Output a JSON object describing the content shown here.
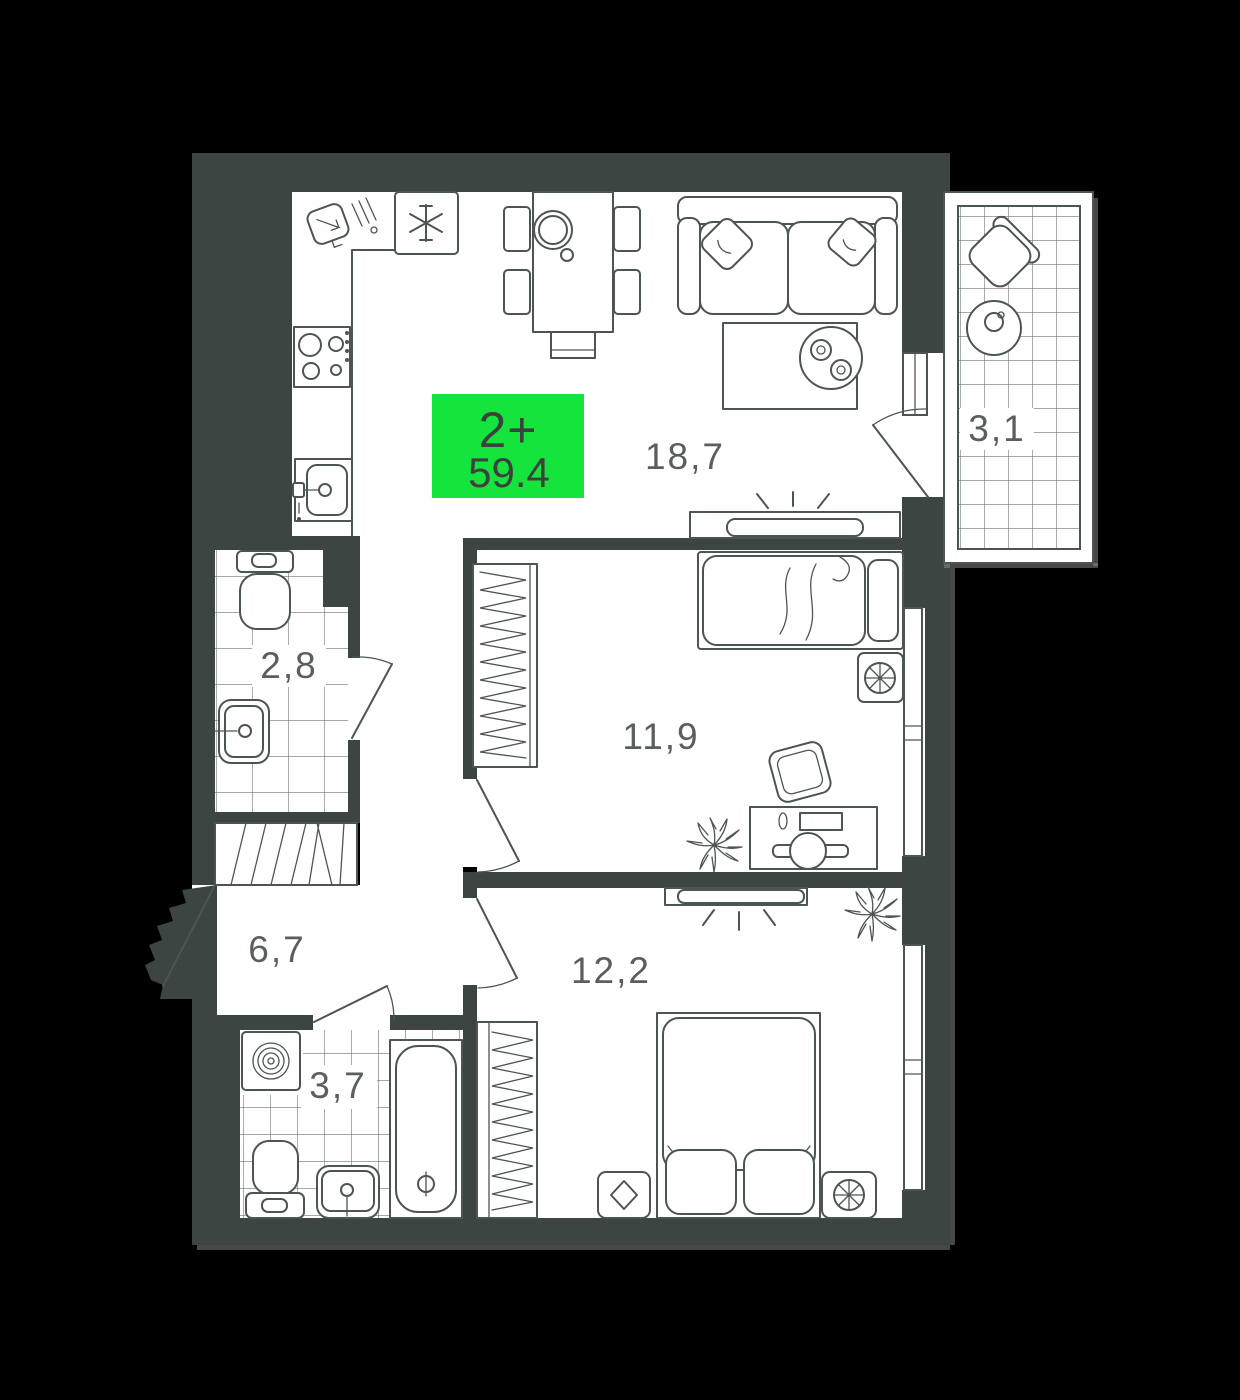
{
  "plan": {
    "badge": {
      "rooms_label": "2+",
      "total_area": "59.4",
      "bg_color": "#15e43c",
      "text_color": "#3a4240"
    },
    "rooms": [
      {
        "id": "kitchen-living",
        "area_label": "18,7"
      },
      {
        "id": "balcony",
        "area_label": "3,1"
      },
      {
        "id": "bathroom-small",
        "area_label": "2,8"
      },
      {
        "id": "bedroom-1",
        "area_label": "11,9"
      },
      {
        "id": "hallway",
        "area_label": "6,7"
      },
      {
        "id": "bedroom-2",
        "area_label": "12,2"
      },
      {
        "id": "bathroom-big",
        "area_label": "3,7"
      }
    ],
    "colors": {
      "background": "#000000",
      "wall": "#3d4543",
      "floor": "#ffffff",
      "outline": "#4d5553",
      "tile_grid": "#6d7472",
      "label_text": "#585f5d"
    }
  }
}
